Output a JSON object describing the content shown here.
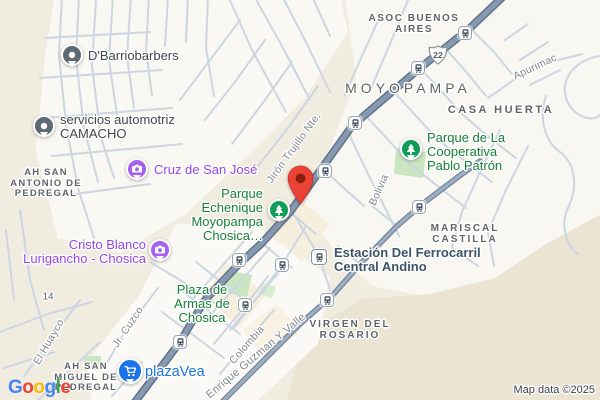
{
  "map": {
    "attribution": "Map data ©2025",
    "logo_letters": [
      {
        "ch": "G",
        "color": "#4285F4"
      },
      {
        "ch": "o",
        "color": "#EA4335"
      },
      {
        "ch": "o",
        "color": "#FBBC04"
      },
      {
        "ch": "g",
        "color": "#4285F4"
      },
      {
        "ch": "l",
        "color": "#34A853"
      },
      {
        "ch": "e",
        "color": "#EA4335"
      }
    ],
    "route_shield": {
      "number": "22",
      "x": 438,
      "y": 55
    },
    "dropped_pin": {
      "x": 300,
      "y": 204
    },
    "colors": {
      "highway": "#8699b1",
      "highway_casing": "#5f7389",
      "avenue": "#9fb0c4",
      "avenue_casing": "#72849b",
      "street": "#ccd6e2",
      "park": "#c9e6c0",
      "urban": "#f9f8f3",
      "terrain": "#f1ece0",
      "hill": "#ebe4d3",
      "poi_gray": "#40464c",
      "poi_purple": "#9646e6",
      "poi_green": "#188038",
      "poi_blue": "#1a73e8",
      "poi_transit": "#3e5468",
      "pin_red": "#EA4335",
      "pin_green": "#0f9d58",
      "pin_purple": "#a660ee",
      "pin_gray": "#5f6b74",
      "pin_blue": "#1a73e8"
    },
    "pin_styles": {
      "generic": {
        "color": "#5f6b74",
        "glyph": "dot"
      },
      "camera": {
        "color": "#a660ee",
        "glyph": "camera"
      },
      "tree": {
        "color": "#0f9d58",
        "glyph": "tree"
      },
      "cart": {
        "color": "#1a73e8",
        "glyph": "cart"
      }
    },
    "poi": [
      {
        "id": "dbarriobarbers",
        "lines": [
          "D'Barriobarbers"
        ],
        "x": 88,
        "y": 56,
        "align": "left",
        "color": "gray",
        "pin": {
          "type": "generic",
          "x": 72,
          "y": 55
        }
      },
      {
        "id": "servicios-automotriz-camacho",
        "lines": [
          "servicios automotriz",
          "CAMACHO"
        ],
        "x": 60,
        "y": 127,
        "align": "left",
        "color": "gray",
        "pin": {
          "type": "generic",
          "x": 44,
          "y": 126
        }
      },
      {
        "id": "cruz-de-san-jose",
        "lines": [
          "Cruz de San José"
        ],
        "x": 154,
        "y": 170,
        "align": "left",
        "color": "purple",
        "pin": {
          "type": "camera",
          "x": 137,
          "y": 169
        }
      },
      {
        "id": "cristo-blanco",
        "lines": [
          "Cristo Blanco",
          "Lurigancho - Chosica"
        ],
        "x": 146,
        "y": 252,
        "align": "right",
        "color": "purple",
        "pin": {
          "type": "camera",
          "x": 160,
          "y": 250
        }
      },
      {
        "id": "parque-echenique",
        "lines": [
          "Parque",
          "Echenique",
          "Moyopampa",
          "Chosica…"
        ],
        "x": 263,
        "y": 215,
        "align": "right",
        "color": "green",
        "pin": {
          "type": "tree",
          "x": 279,
          "y": 210
        }
      },
      {
        "id": "parque-cooperativa-pablo-patron",
        "lines": [
          "Parque de La",
          "Cooperativa",
          "Pablo Patrón"
        ],
        "x": 427,
        "y": 152,
        "align": "left",
        "color": "green",
        "pin": {
          "type": "tree",
          "x": 411,
          "y": 149
        }
      },
      {
        "id": "plaza-de-armas-de-chosica",
        "lines": [
          "Plaza de",
          "Armas de",
          "Chosica"
        ],
        "x": 202,
        "y": 304,
        "align": "center",
        "color": "green"
      },
      {
        "id": "estacion-ferrocarril-central-andino",
        "lines": [
          "Estación Del Ferrocarril",
          "Central Andino"
        ],
        "x": 334,
        "y": 260,
        "align": "left",
        "color": "slate"
      },
      {
        "id": "plazavea",
        "lines": [
          "plazaVea"
        ],
        "x": 145,
        "y": 372,
        "align": "left",
        "color": "blue",
        "size": 14.5,
        "weight": 500,
        "pin": {
          "type": "cart",
          "x": 130,
          "y": 371,
          "big": true
        }
      }
    ],
    "areas": [
      {
        "id": "asoc-buenos-aires",
        "lines": [
          "ASOC BUENOS",
          "AIRES"
        ],
        "x": 414,
        "y": 24,
        "size": 10,
        "ls": 1.5
      },
      {
        "id": "moyopampa",
        "lines": [
          "MOYOPAMPA"
        ],
        "x": 408,
        "y": 89,
        "size": 14,
        "ls": 4,
        "weight": 500
      },
      {
        "id": "casa-huerta",
        "lines": [
          "CASA HUERTA"
        ],
        "x": 501,
        "y": 110,
        "size": 11,
        "ls": 2.5
      },
      {
        "id": "mariscal-castilla",
        "lines": [
          "MARISCAL",
          "CASTILLA"
        ],
        "x": 465,
        "y": 234,
        "size": 10,
        "ls": 2
      },
      {
        "id": "virgen-del-rosario",
        "lines": [
          "VIRGEN DEL",
          "ROSARIO"
        ],
        "x": 350,
        "y": 330,
        "size": 10,
        "ls": 2
      },
      {
        "id": "ah-san-antonio-de-pedregal",
        "lines": [
          "AH SAN",
          "ANTONIO DE",
          "PEDREGAL"
        ],
        "x": 46,
        "y": 184,
        "size": 9.5,
        "ls": 1.2
      },
      {
        "id": "ah-san-miguel-de-pedregal",
        "lines": [
          "AH SAN",
          "MIGUEL DE",
          "PEDREGAL"
        ],
        "x": 86,
        "y": 378,
        "size": 9.5,
        "ls": 1.2
      },
      {
        "id": "block-14",
        "lines": [
          "14"
        ],
        "x": 48,
        "y": 297,
        "size": 10,
        "ls": 0,
        "weight": 400
      }
    ],
    "streets": [
      {
        "id": "jiron-trujillo-nte",
        "text": "Jirón Trujillo Nte.",
        "x": 294,
        "y": 148,
        "angle": -54
      },
      {
        "id": "bolivia",
        "text": "Bolivia",
        "x": 379,
        "y": 190,
        "angle": -66
      },
      {
        "id": "apurimac",
        "text": "Apurimac",
        "x": 535,
        "y": 67,
        "angle": -25
      },
      {
        "id": "colombia",
        "text": "Colombia",
        "x": 247,
        "y": 345,
        "angle": -49
      },
      {
        "id": "enrique-guzman-y-valle",
        "text": "Enrique Guzman Y Valle",
        "x": 256,
        "y": 356,
        "angle": -40,
        "size": 11
      },
      {
        "id": "jr-cuzco",
        "text": "Jr. Cuzco",
        "x": 128,
        "y": 327,
        "angle": -56
      },
      {
        "id": "el-huayco",
        "text": "El Huayco",
        "x": 49,
        "y": 342,
        "angle": -60
      }
    ],
    "transit_stops": [
      {
        "x": 465,
        "y": 33
      },
      {
        "x": 418,
        "y": 68
      },
      {
        "x": 355,
        "y": 123
      },
      {
        "x": 325,
        "y": 171
      },
      {
        "x": 419,
        "y": 207
      },
      {
        "x": 239,
        "y": 260
      },
      {
        "x": 282,
        "y": 265
      },
      {
        "x": 245,
        "y": 305
      },
      {
        "x": 327,
        "y": 300
      },
      {
        "x": 180,
        "y": 342
      }
    ],
    "station_icon": {
      "x": 319,
      "y": 257
    }
  }
}
